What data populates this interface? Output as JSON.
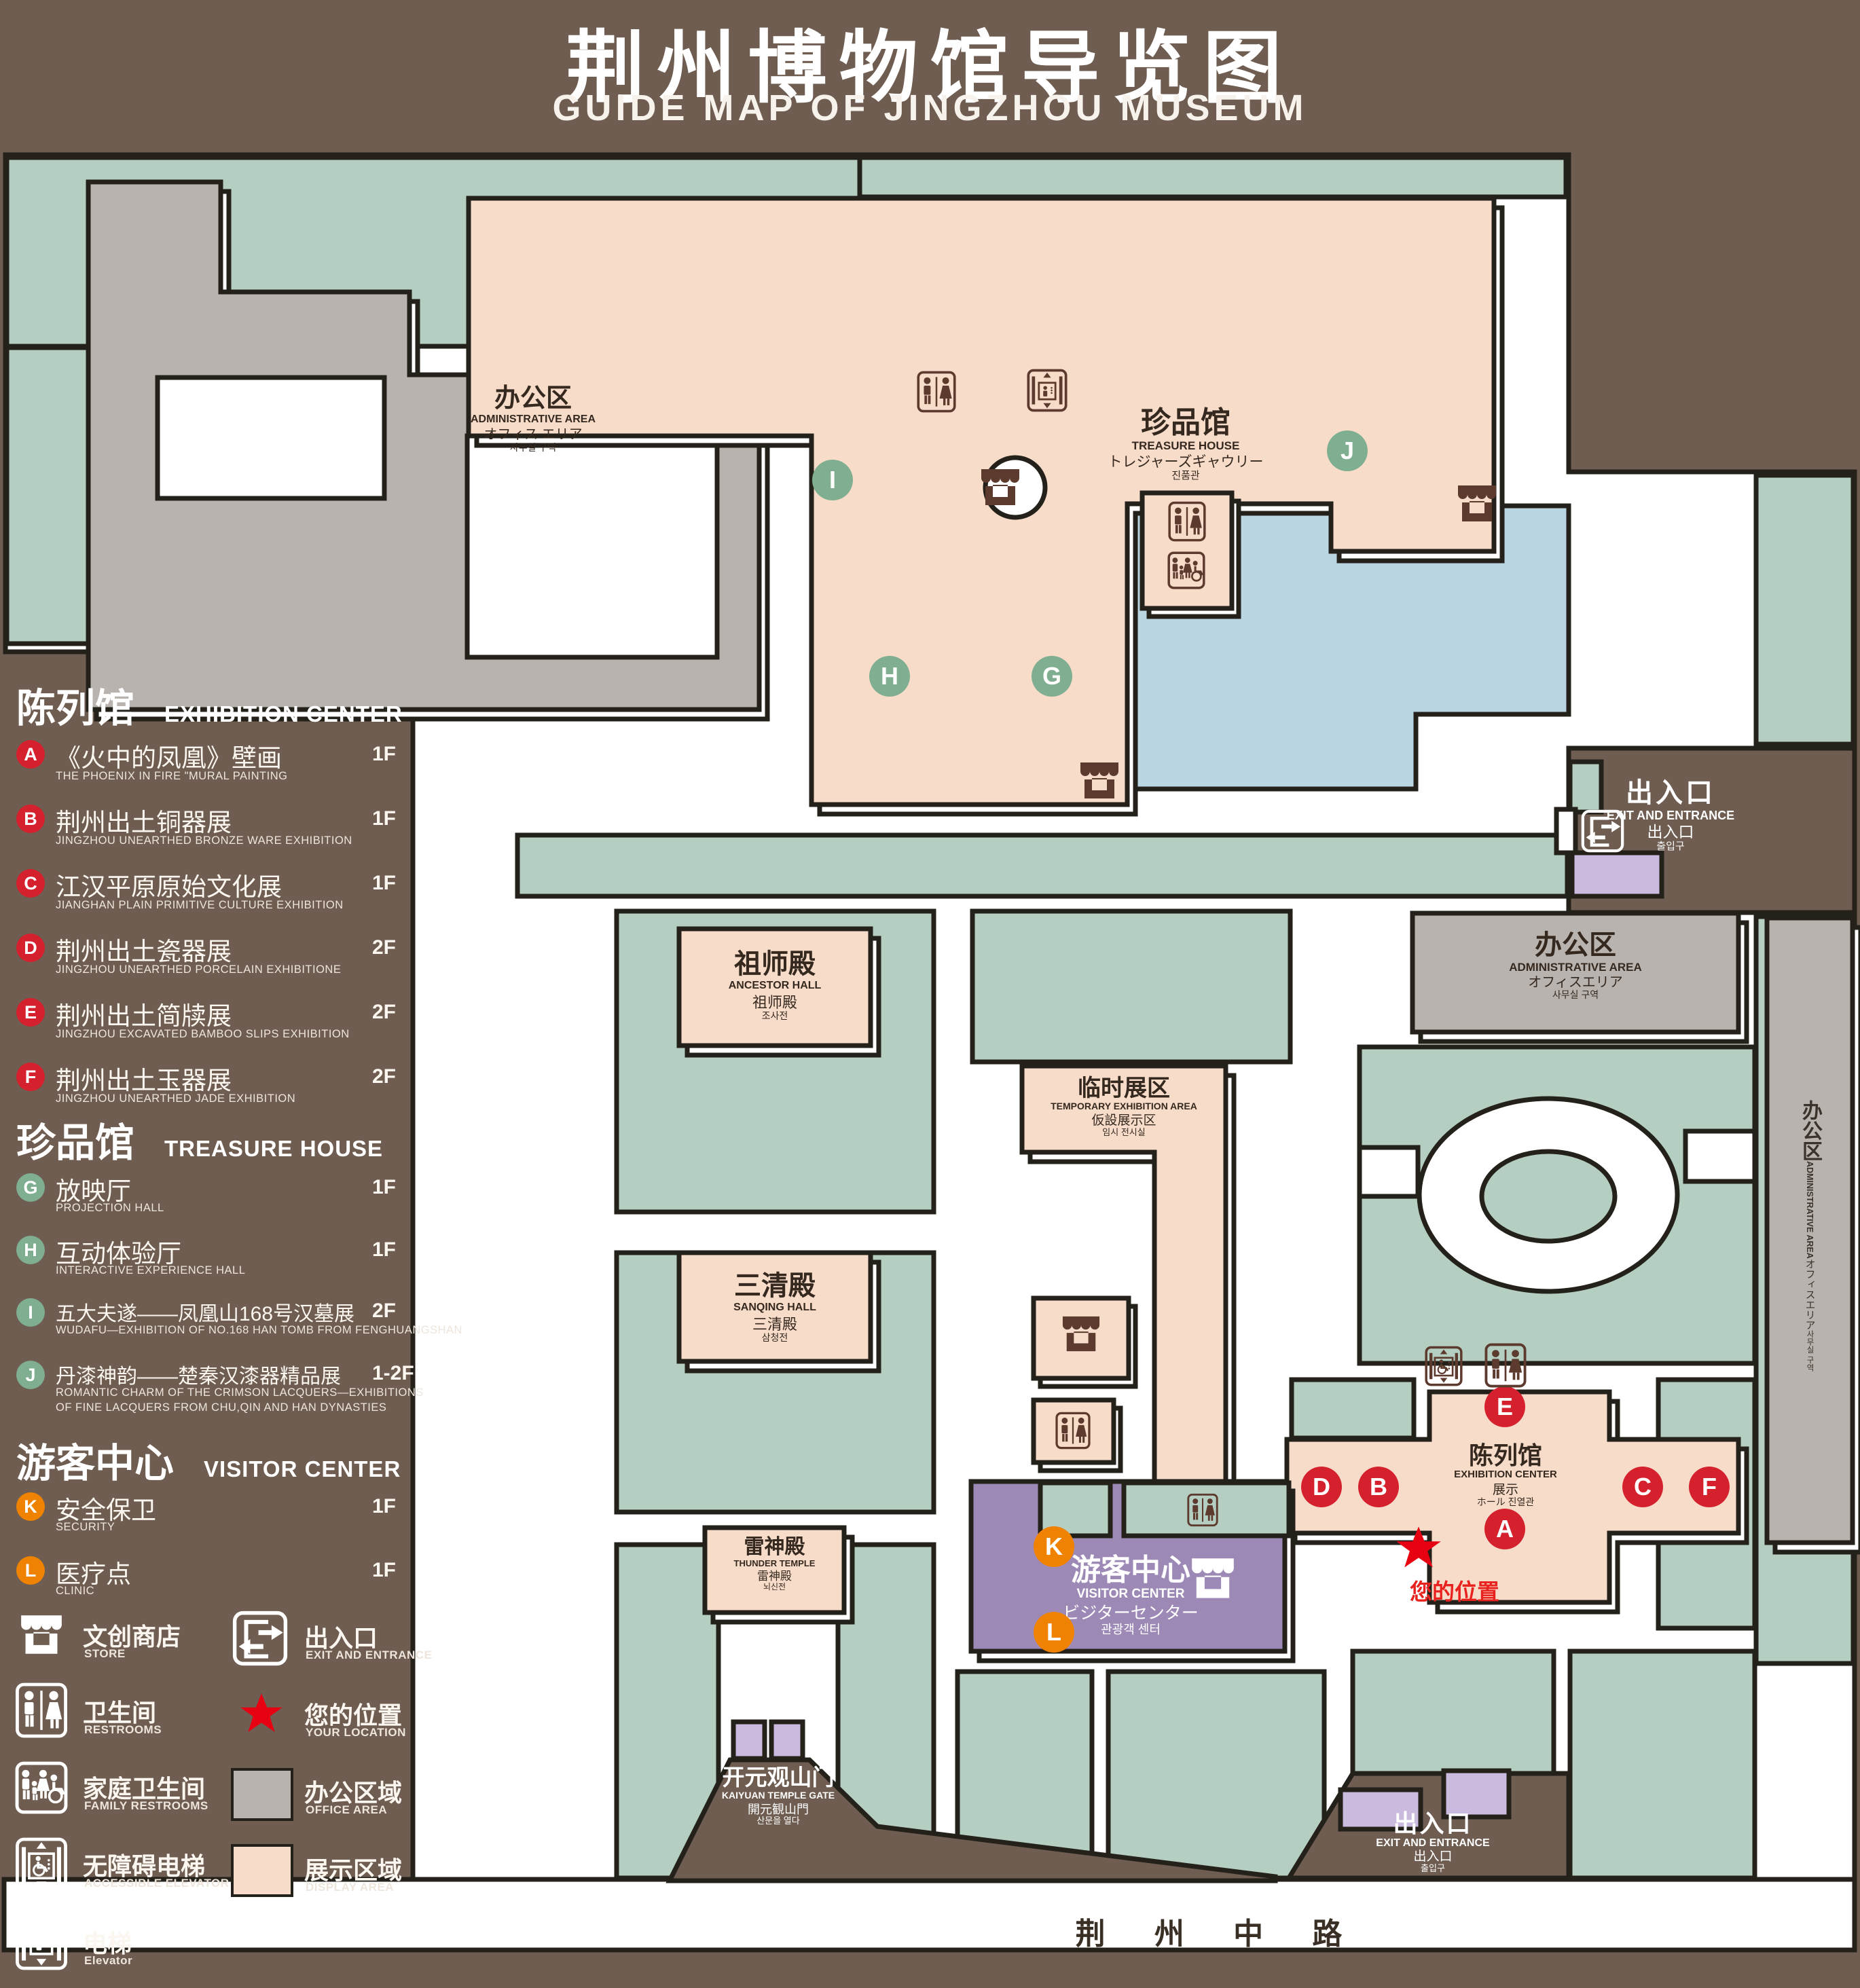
{
  "page": {
    "title_zh": "荆州博物馆导览图",
    "title_en": "GUIDE MAP OF JINGZHOU MUSEUM"
  },
  "legend": {
    "sections": [
      {
        "zh": "陈列馆",
        "en": "EXHIBITION CENTER",
        "items": [
          {
            "letter": "A",
            "zh": "《火中的凤凰》壁画",
            "en": "THE PHOENIX IN FIRE \"MURAL PAINTING",
            "floor": "1F"
          },
          {
            "letter": "B",
            "zh": "荆州出土铜器展",
            "en": "JINGZHOU UNEARTHED BRONZE WARE EXHIBITION",
            "floor": "1F"
          },
          {
            "letter": "C",
            "zh": "江汉平原原始文化展",
            "en": "JIANGHAN PLAIN PRIMITIVE CULTURE EXHIBITION",
            "floor": "1F"
          },
          {
            "letter": "D",
            "zh": "荆州出土瓷器展",
            "en": "JINGZHOU UNEARTHED PORCELAIN EXHIBITIONE",
            "floor": "2F"
          },
          {
            "letter": "E",
            "zh": "荆州出土简牍展",
            "en": "JINGZHOU EXCAVATED BAMBOO SLIPS EXHIBITION",
            "floor": "2F"
          },
          {
            "letter": "F",
            "zh": "荆州出土玉器展",
            "en": "JINGZHOU UNEARTHED JADE EXHIBITION",
            "floor": "2F"
          }
        ]
      },
      {
        "zh": "珍品馆",
        "en": "TREASURE HOUSE",
        "items": [
          {
            "letter": "G",
            "zh": "放映厅",
            "en": "PROJECTION HALL",
            "floor": "1F"
          },
          {
            "letter": "H",
            "zh": "互动体验厅",
            "en": "INTERACTIVE EXPERIENCE HALL",
            "floor": "1F"
          },
          {
            "letter": "I",
            "zh": "五大夫遂——凤凰山168号汉墓展",
            "en": "WUDAFU—EXHIBITION OF NO.168 HAN TOMB FROM FENGHUANGSHAN",
            "floor": "2F"
          },
          {
            "letter": "J",
            "zh": "丹漆神韵——楚秦汉漆器精品展",
            "en": "ROMANTIC CHARM OF THE CRIMSON LACQUERS—EXHIBITIONS",
            "en2": "OF FINE LACQUERS FROM CHU,QIN AND HAN DYNASTIES",
            "floor": "1-2F"
          }
        ]
      },
      {
        "zh": "游客中心",
        "en": "VISITOR CENTER",
        "items": [
          {
            "letter": "K",
            "zh": "安全保卫",
            "en": "SECURITY",
            "floor": "1F"
          },
          {
            "letter": "L",
            "zh": "医疗点",
            "en": "CLINIC",
            "floor": "1F"
          }
        ]
      }
    ],
    "symbols_left": [
      {
        "icon": "store-icon",
        "zh": "文创商店",
        "en": "STORE"
      },
      {
        "icon": "restrooms-icon",
        "zh": "卫生间",
        "en": "RESTROOMS"
      },
      {
        "icon": "family-restrooms-icon",
        "zh": "家庭卫生间",
        "en": "FAMILY RESTROOMS"
      },
      {
        "icon": "accessible-elevator-icon",
        "zh": "无障碍电梯",
        "en": "ACCESSIBLE ELEVATOR"
      },
      {
        "icon": "elevator-icon",
        "zh": "电梯",
        "en": "Elevator"
      }
    ],
    "symbols_right": [
      {
        "icon": "exit-icon",
        "zh": "出入口",
        "en": "EXIT AND ENTRANCE"
      },
      {
        "icon": "your-location-star",
        "zh": "您的位置",
        "en": "YOUR LOCATION"
      },
      {
        "swatch": "#b9b3af",
        "zh": "办公区域",
        "en": "OFFICE AREA"
      },
      {
        "swatch": "#f8dcca",
        "zh": "展示区域",
        "en": "DISPLAY AREA"
      }
    ]
  },
  "map": {
    "buildings": {
      "admin_nw": {
        "zh": "办公区",
        "en": "ADMINISTRATIVE AREA",
        "jp": "オフィス エリア",
        "kr": "사무실 구역"
      },
      "treasure_house": {
        "zh": "珍品馆",
        "en": "TREASURE HOUSE",
        "jp": "トレジャーズギャウリー",
        "kr": "진품관"
      },
      "ancestor_hall": {
        "zh": "祖师殿",
        "en": "ANCESTOR HALL",
        "zh2": "祖师殿",
        "kr": "조사전"
      },
      "temporary_exhibition_area": {
        "zh": "临时展区",
        "en": "TEMPORARY EXHIBITION AREA",
        "jp": "仮設展示区",
        "kr": "임시 전시실"
      },
      "sanqing_hall": {
        "zh": "三清殿",
        "en": "SANQING HALL",
        "zh2": "三清殿",
        "kr": "삼청전"
      },
      "thunder_temple": {
        "zh": "雷神殿",
        "en": "THUNDER TEMPLE",
        "zh2": "雷神殿",
        "kr": "뇌신전"
      },
      "visitor_center": {
        "zh": "游客中心",
        "en": "VISITOR CENTER",
        "jp": "ビジターセンター",
        "kr": "관광객 센터"
      },
      "exhibition_center": {
        "zh": "陈列馆",
        "en": "EXHIBITION CENTER",
        "zh2": "展示",
        "mix": "ホール 진열관"
      },
      "admin_mid": {
        "zh": "办公区",
        "en": "ADMINISTRATIVE AREA",
        "jp": "オフィスエリア",
        "kr": "사무실 구역"
      },
      "admin_right": {
        "zh": "办公区",
        "en": "ADMINISTRATIVE AREA",
        "jp": "オフィスエリア",
        "kr": "사무실 구역"
      },
      "kaiyuan_gate": {
        "zh": "开元观山门",
        "en": "KAIYUAN TEMPLE GATE",
        "jp": "開元観山門",
        "kr": "산문을 열다"
      }
    },
    "exit_east": {
      "zh": "出入口",
      "en": "EXIT AND ENTRANCE",
      "zh2": "出入口",
      "kr": "출입구"
    },
    "exit_south": {
      "zh": "出入口",
      "en": "EXIT AND ENTRANCE",
      "zh2": "出入口",
      "kr": "출입구"
    },
    "your_location": "您的位置",
    "road": "荆 州 中 路"
  },
  "colors": {
    "background": "#6e5d50",
    "lawn_green": "#b5cec2",
    "display_pink": "#f8dcca",
    "office_gray": "#b9b3af",
    "pond_blue": "#bad6e2",
    "visitor_purple": "#9d89b6",
    "lavender": "#cabadd",
    "marker_red": "#d5212e",
    "marker_green": "#7fae90",
    "marker_orange": "#ef8200",
    "star_red": "#e60012",
    "line": "#24201a"
  }
}
